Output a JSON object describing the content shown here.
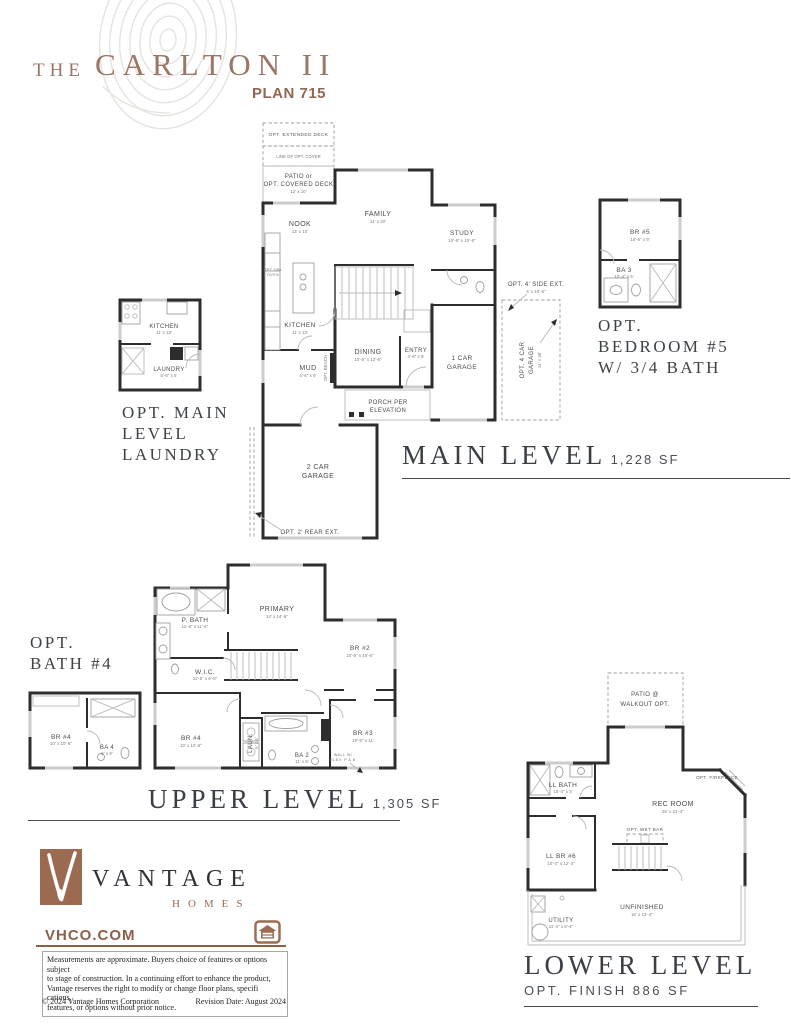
{
  "header": {
    "prefix": "THE",
    "title": "CARLTON II",
    "plan": "PLAN 715"
  },
  "main": {
    "title": "MAIN LEVEL",
    "sqft": "1,228 SF",
    "rooms": {
      "deck": "OPT. EXTENDED DECK",
      "cover": "LINE OF OPT. COVER",
      "patio1": "PATIO or",
      "patio2": "OPT. COVERED DECK",
      "patio_dim": "12' x 10'",
      "family": "FAMILY",
      "family_dim": "14' x 20'",
      "nook": "NOOK",
      "nook_dim": "12' x 10'",
      "study": "STUDY",
      "study_dim": "10'-6\" x 10'-6\"",
      "kitchen": "KITCHEN",
      "kitchen_dim": "11' x 13'",
      "dbl1": "OPT DBL",
      "dbl2": "OVEN",
      "dining": "DINING",
      "dining_dim": "10'-6\" x 12'-6\"",
      "entry": "ENTRY",
      "entry_dim": "4'-6\" x 8'",
      "mud": "MUD",
      "mud_dim": "5'-6\" x 6'",
      "bench": "OPT. BENCH",
      "gar1a": "1 CAR",
      "gar1b": "GARAGE",
      "porch1": "PORCH PER",
      "porch2": "ELEVATION",
      "gar2a": "2 CAR",
      "gar2b": "GARAGE",
      "rear": "OPT. 2' REAR EXT.",
      "side": "OPT. 4' SIDE EXT.",
      "side_dim": "4' x 10'-6\"",
      "car4a": "OPT. 4 CAR",
      "car4b": "GARAGE",
      "car4_dim": "14' x 38'"
    }
  },
  "laundry_inset": {
    "label1": "OPT. MAIN",
    "label2": "LEVEL",
    "label3": "LAUNDRY",
    "kitchen": "KITCHEN",
    "kitchen_dim": "11' x 13'",
    "laundry": "LAUNDRY",
    "laundry_dim": "5'-6\" x 6'"
  },
  "bedroom5_inset": {
    "label1": "OPT.",
    "label2": "BEDROOM #5",
    "label3": "W/ 3/4 BATH",
    "br5": "BR #5",
    "br5_dim": "10'-6\" x 9'",
    "ba3": "BA 3",
    "ba3_dim": "10'-4\" x 5'"
  },
  "bath4_inset": {
    "label1": "OPT.",
    "label2": "BATH #4",
    "br4": "BR #4",
    "br4_dim": "10' x 10'-6\"",
    "ba4": "BA 4",
    "ba4_dim": "6' x 8'"
  },
  "upper": {
    "title": "UPPER LEVEL",
    "sqft": "1,305 SF",
    "rooms": {
      "primary": "PRIMARY",
      "primary_dim": "14' x 14'-6\"",
      "pbath": "P. BATH",
      "pbath_dim": "11'-6\" x 11'-6\"",
      "wic": "W.I.C.",
      "wic_dim": "11'-6\" x 6'-6\"",
      "br2": "BR #2",
      "br2_dim": "10'-6\" x 10'-6\"",
      "br3": "BR #3",
      "br3_dim": "10'-6\" x 11'",
      "br4": "BR #4",
      "br4_dim": "10' x 10'-6\"",
      "laun": "LAUN.",
      "laun_dim": "5' x 6'",
      "ba2": "BA 2",
      "ba2_dim": "11' x 5'",
      "wall1": "WALL W/",
      "wall2": "ELEV. P & B"
    }
  },
  "lower": {
    "title": "LOWER LEVEL",
    "sqft": "OPT. FINISH 886 SF",
    "rooms": {
      "patio1": "PATIO @",
      "patio2": "WALKOUT OPT.",
      "llbath": "LL BATH",
      "llbath_dim": "10'-4\" x 5'",
      "fireplace": "OPT. FIREPLACE",
      "rec": "REC ROOM",
      "rec_dim": "26' x 21'-4\"",
      "wetbar": "OPT. WET BAR",
      "llbr6": "LL BR #6",
      "llbr6_dim": "10'-4\" x 12'-4\"",
      "utility": "UTILITY",
      "utility_dim": "11'-4\" x 8'-4\"",
      "unfinished": "UNFINISHED",
      "unfinished_dim": "16' x 12'-4\""
    }
  },
  "footer": {
    "brand": "VANTAGE",
    "brand_sub": "HOMES",
    "site": "VHCO.COM",
    "d1": "Measurements are approximate. Buyers choice of features or options subject",
    "d2": "to stage of construction. In a continuing effort to enhance the product,",
    "d3": "Vantage reserves the right to modify or change floor plans, specifi cations,",
    "d4": "features, or options without prior notice.",
    "copyright": "© 2024 Vantage Homes Corporation",
    "revision": "Revision Date: August 2024"
  },
  "colors": {
    "accent_brown": "#8d5f46",
    "title_brown": "#9b7566",
    "ink": "#3a3f46",
    "wall": "#2d2d2d"
  }
}
